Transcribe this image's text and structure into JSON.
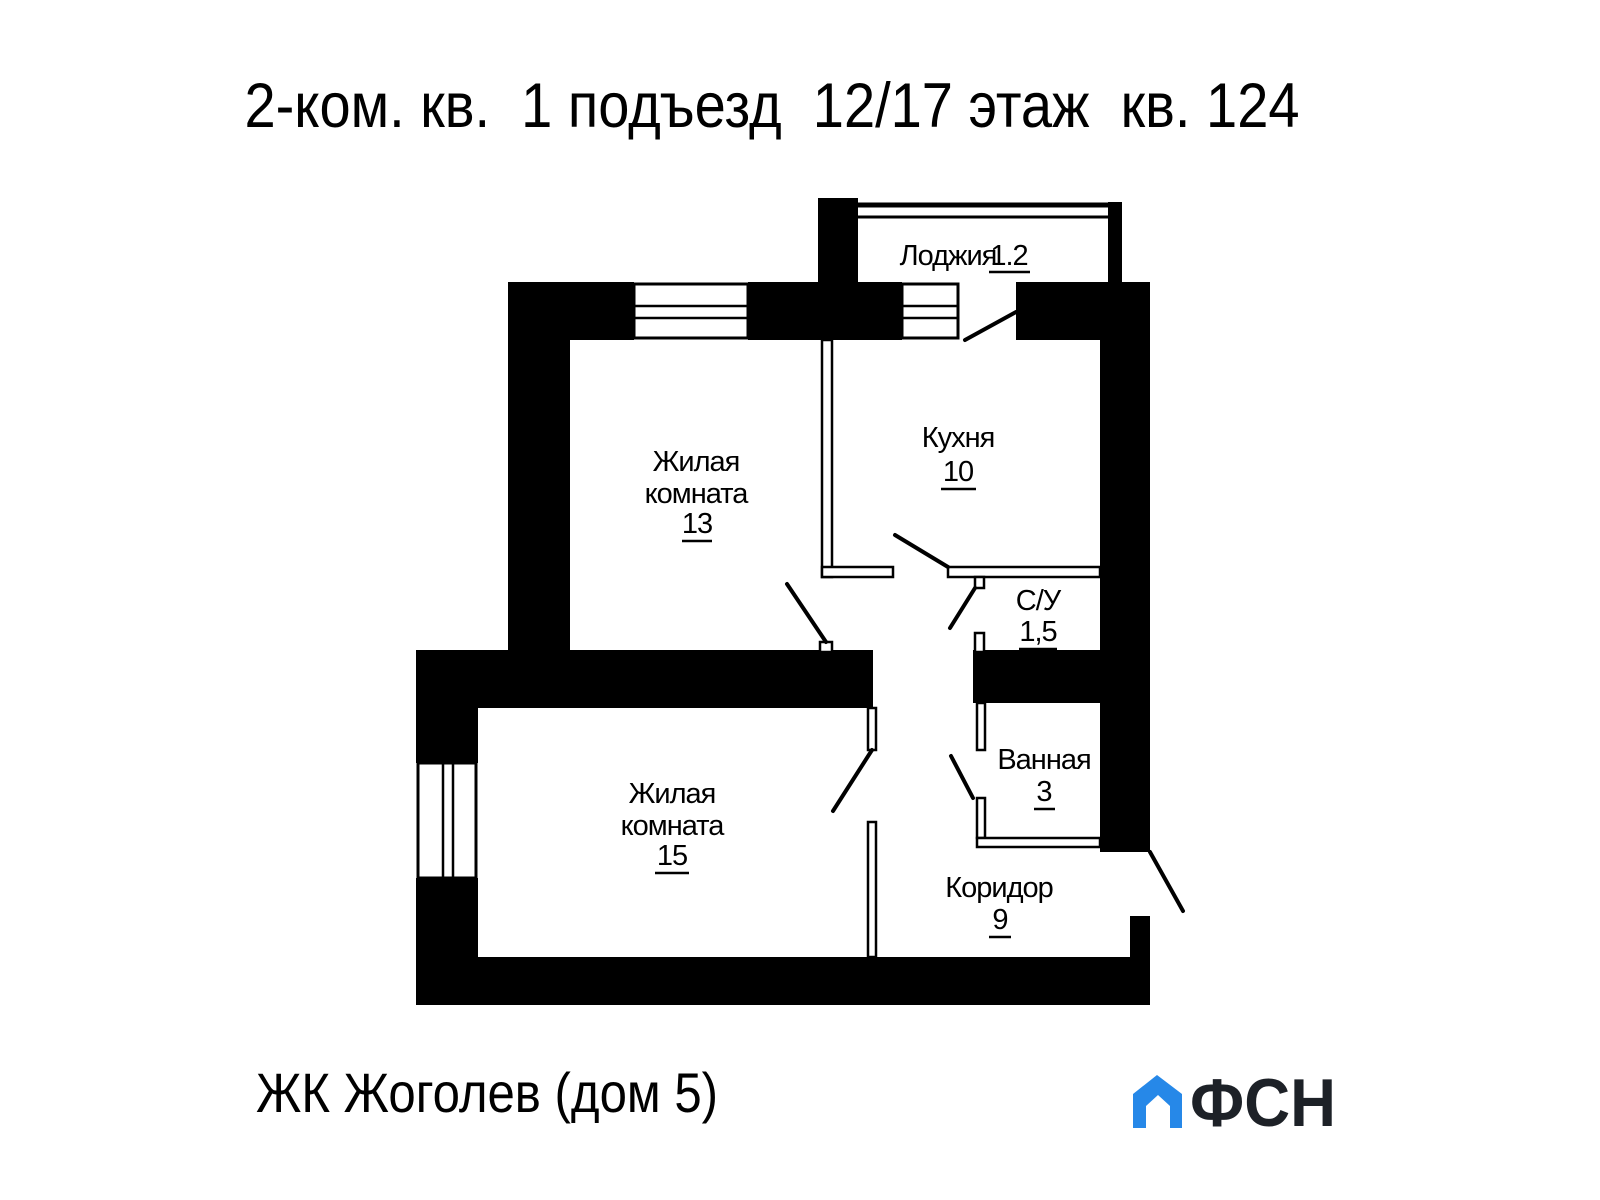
{
  "title": "2-ком. кв.  1 подъезд  12/17 этаж  кв. 124",
  "rooms": {
    "loggia": {
      "name": "Лоджия",
      "area": "1.2"
    },
    "kitchen": {
      "name": "Кухня",
      "area": "10"
    },
    "room13": {
      "name1": "Жилая",
      "name2": "комната",
      "area": "13"
    },
    "wc": {
      "name": "С/У",
      "area": "1,5"
    },
    "bathroom": {
      "name": "Ванная",
      "area": "3"
    },
    "room15": {
      "name1": "Жилая",
      "name2": "комната",
      "area": "15"
    },
    "corridor": {
      "name": "Коридор",
      "area": "9"
    }
  },
  "footer": {
    "project": "ЖК Жоголев (дом 5)",
    "logo_text": "ФСН",
    "logo_color": "#2688e8",
    "logo_text_color": "#1d2127"
  }
}
